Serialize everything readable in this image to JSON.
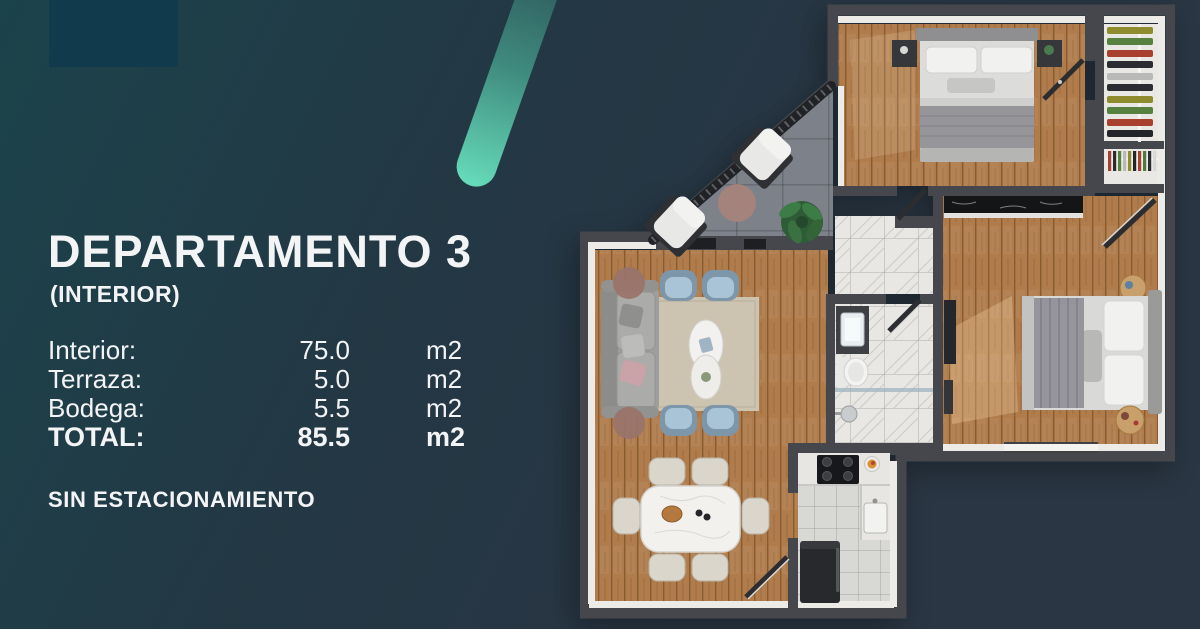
{
  "panel": {
    "title": "DEPARTAMENTO 3",
    "subtitle": "(INTERIOR)",
    "areas": [
      {
        "label": "Interior:",
        "value": "75.0",
        "unit": "m2"
      },
      {
        "label": "Terraza:",
        "value": "5.0",
        "unit": "m2"
      },
      {
        "label": "Bodega:",
        "value": "5.5",
        "unit": "m2"
      },
      {
        "label": "TOTAL:",
        "value": "85.5",
        "unit": "m2"
      }
    ],
    "note": "SIN ESTACIONAMIENTO"
  },
  "palette": {
    "bg_grad_a": "#1b434b",
    "bg_grad_b": "#243744",
    "bg_grad_c": "#2a3643",
    "corner_rect": "#113a4c",
    "stripe_top": "#2e5a5c",
    "stripe_bottom": "#66dcba",
    "text": "#f3f4f6",
    "wall": "#45474c",
    "wall_lining": "#edebe7",
    "wood": "#b07c4c",
    "marble": "#e9e7e3",
    "tile": "#d8d8d5",
    "terrace": "#7d818a",
    "rug": "#cdc3b1",
    "sofa": "#9e9e9c",
    "chair_blue": "#7e96aa",
    "chair_blue_seat": "#a9c4d6",
    "dining_chair": "#dbd6cb",
    "counter_black": "#141517",
    "fridge": "#28292d",
    "plant": "#3e7c47",
    "side_table": "#9a746a",
    "closet_floor": "#eae8e4"
  },
  "floor_plan": {
    "type": "top-down 3D apartment render",
    "closet_clothes_colors": [
      "#a8402f",
      "#56813f",
      "#2a2c31",
      "#8f8c2e",
      "#b9b9b7"
    ]
  }
}
